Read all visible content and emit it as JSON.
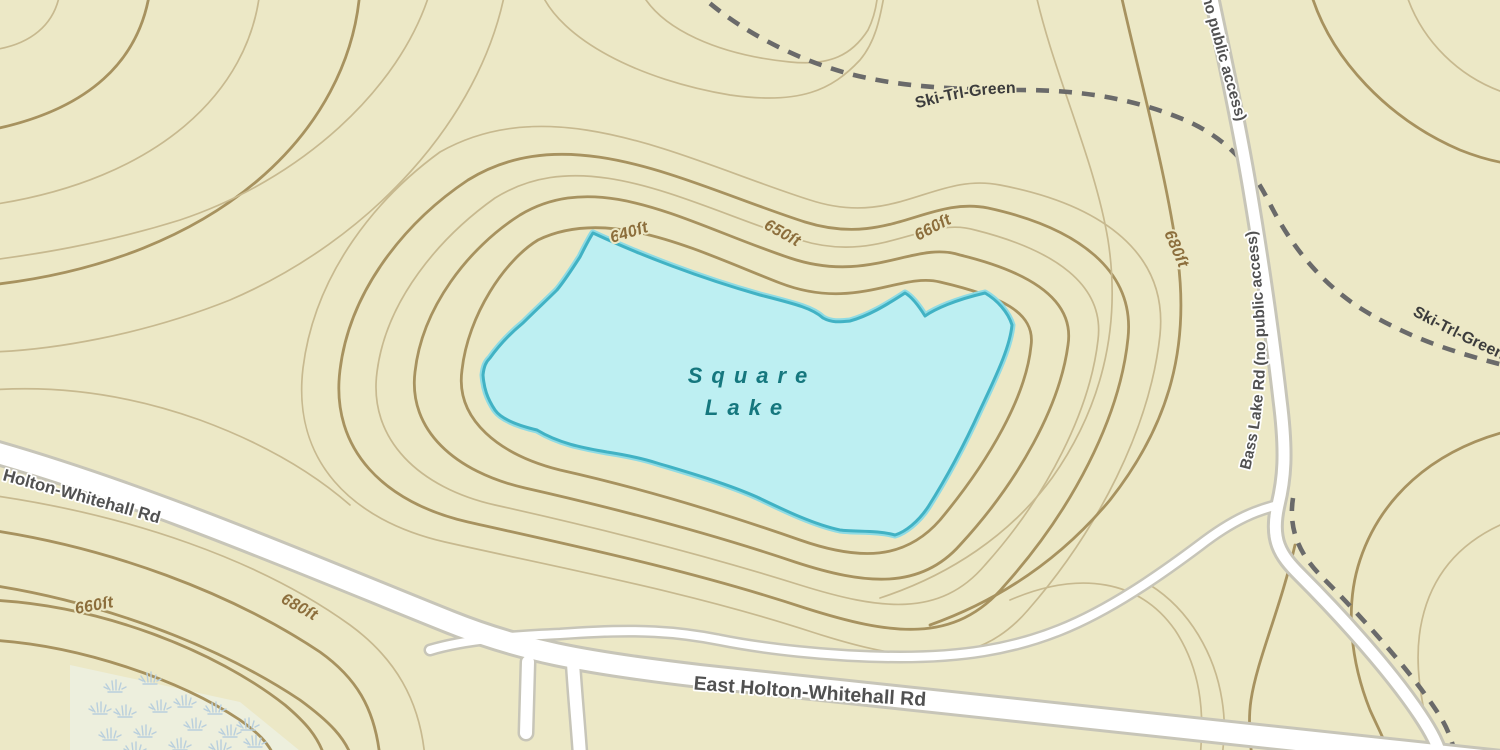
{
  "map": {
    "background_color": "#ece8c6",
    "lake": {
      "name_line1": "Square",
      "name_line2": "Lake",
      "fill": "#bdeff2",
      "outline": "#41b2c4",
      "label_color": "#15777e"
    },
    "roads": {
      "label_color": "#515151",
      "holton_whitehall": {
        "label": "Holton-Whitehall Rd"
      },
      "east_holton_whitehall": {
        "label": "East Holton-Whitehall Rd"
      },
      "bass_lake": {
        "label": "Bass Lake Rd (no public access)"
      }
    },
    "trails": {
      "color": "#6a6a6a",
      "label_color": "#3c3c3c",
      "ski_trl_green": {
        "label": "Ski-Trl-Green"
      }
    },
    "contours": {
      "color_major": "#a7925f",
      "color_minor": "#c7b98f",
      "label_color": "#8c6e3c",
      "labels": [
        {
          "text": "640ft",
          "position": "lake-north-west"
        },
        {
          "text": "650ft",
          "position": "lake-north"
        },
        {
          "text": "660ft",
          "position": "lake-north-east"
        },
        {
          "text": "680ft",
          "position": "east-vertical"
        },
        {
          "text": "660ft",
          "position": "south-west-hill"
        },
        {
          "text": "680ft",
          "position": "south-west-hill-outer"
        }
      ]
    },
    "marsh": {
      "color": "#b9cfdd",
      "tufts": [
        [
          115,
          690
        ],
        [
          150,
          682
        ],
        [
          185,
          705
        ],
        [
          215,
          712
        ],
        [
          125,
          715
        ],
        [
          160,
          710
        ],
        [
          195,
          728
        ],
        [
          230,
          735
        ],
        [
          110,
          738
        ],
        [
          145,
          735
        ],
        [
          180,
          748
        ],
        [
          220,
          750
        ],
        [
          255,
          745
        ],
        [
          100,
          712
        ],
        [
          135,
          752
        ],
        [
          248,
          728
        ]
      ]
    }
  }
}
